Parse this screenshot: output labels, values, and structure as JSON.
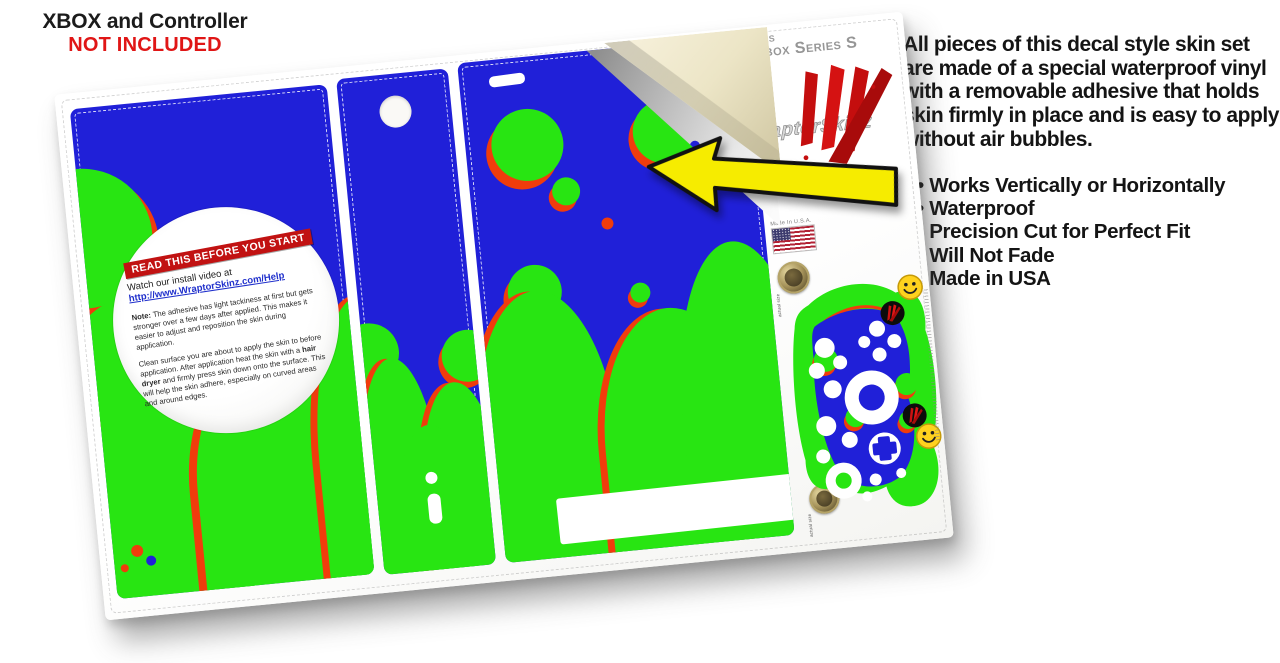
{
  "disclaimer": {
    "line1": "XBOX and Controller",
    "line2": "NOT INCLUDED"
  },
  "description": {
    "paragraph": "All pieces of this decal style skin set are made of a special waterproof vinyl with a removable adhesive that holds skin firmly in place and is easy to apply without air bubbles.",
    "bullets": [
      "Works Vertically or Horizontally",
      "Waterproof",
      "Precision Cut for Perfect Fit",
      "Will Not Fade",
      "Made in USA"
    ]
  },
  "sheet": {
    "fits_label": "Fits",
    "fits_model": "Xbox Series S",
    "brand": "WraptorSkinz",
    "made_in": "Made In U.S.A.",
    "coin_note": "actual size",
    "instructions": {
      "banner": "READ THIS BEFORE YOU START",
      "watch": "Watch our install video at",
      "link": "http://www.WraptorSkinz.com/Help",
      "note_label": "Note:",
      "note_text": " The adhesive has light tackiness at first but gets stronger over a few days after applied. This makes it easier to adjust and reposition the skin during application.",
      "care_1": "Clean surface you are about to apply the skin to before application. After application heat the skin with a ",
      "care_bold": "hair dryer",
      "care_2": " and firmly press skin down onto the surface. This will help the skin adhere, especially on curved areas and around edges."
    },
    "colors": {
      "skin_blue": "#2020d8",
      "skin_green": "#28e512",
      "accent_red": "#f03c0c",
      "backing_cream": "#ece5c6",
      "arrow_yellow": "#f6ec00",
      "banner_red": "#c11212",
      "not_included_red": "#e01616"
    }
  }
}
